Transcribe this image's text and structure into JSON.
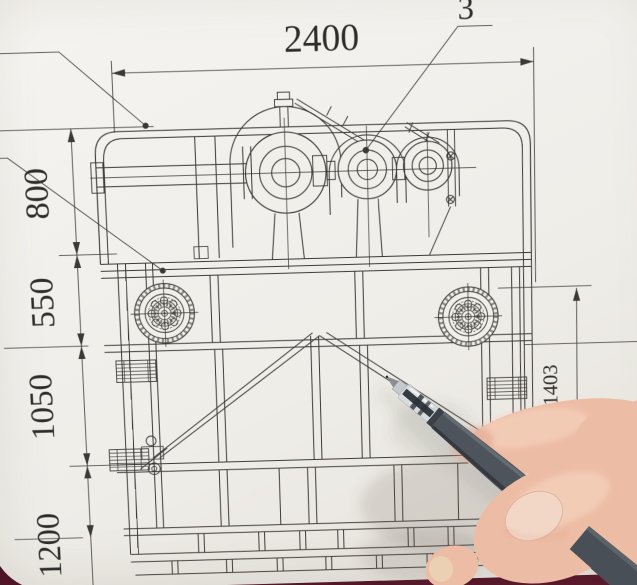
{
  "drawing": {
    "top_dimension": "2400",
    "left_dimensions": [
      "800",
      "550",
      "1050",
      "1200"
    ],
    "right_dimension": "1403",
    "callout_top_left": "2",
    "callout_top_right": "3"
  },
  "colors": {
    "paper": "#f1efe9",
    "ink": "#3b3835",
    "table_dark": "#1d1c1e",
    "table_maroon": "#5a1a2c",
    "pen_barrel": "#4e545b",
    "pen_grip": "#d6dbdf",
    "skin": "#edbca4"
  }
}
